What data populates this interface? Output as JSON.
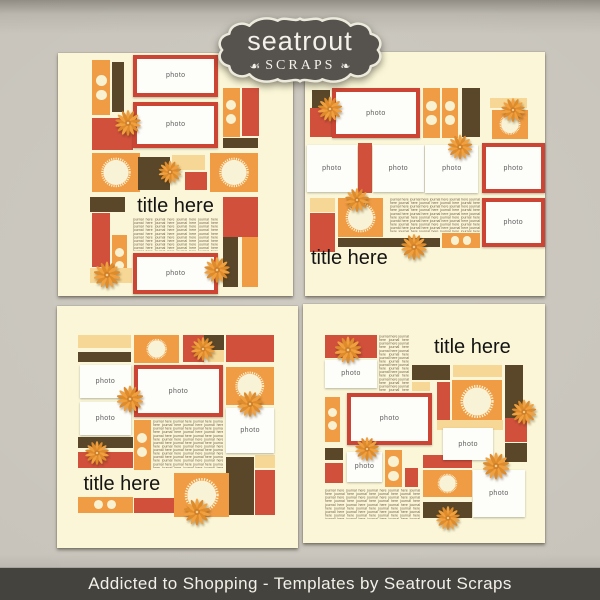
{
  "badge": {
    "brand": "seatrout",
    "subtitle": "SCRAPS",
    "flourish_left": "☙",
    "flourish_right": "❧"
  },
  "footer": {
    "caption": "Addicted to Shopping - Templates by Seatrout Scraps"
  },
  "labels": {
    "photo": "photo",
    "title": "title here",
    "journal_phrase": "journal here",
    "journal_repeat": 110
  },
  "palette": {
    "background": "#c8c4bb",
    "page": "#faf6d7",
    "orange": "#f09c44",
    "red": "#d0503c",
    "brown": "#5a4729",
    "tan": "#f6d795",
    "frame": "#cc4534",
    "photo_bg": "#fdfdfa",
    "photo_label": "#5f5f5f",
    "journal_text": "#75604b",
    "title_text": "#141414",
    "dot": "#f8f2d2",
    "scallop": "#f8f3d6",
    "flower_a": "#f1a03f",
    "flower_b": "#de8b2c",
    "flower_center": "#cf7f2a",
    "flower_dot": "#f2cd8d",
    "badge_bg": "#56534e",
    "badge_border": "#ece9dd",
    "badge_text": "#f3f1ea",
    "footer_bg": "#45433e",
    "footer_text": "#f2f0e8"
  },
  "templates": [
    {
      "name": "top-left",
      "blocks": [
        {
          "t": "dots",
          "dir": "v",
          "x": 14.5,
          "y": 3,
          "w": 7.7,
          "h": 22.5
        },
        {
          "t": "rect",
          "c": "brown",
          "x": 22.8,
          "y": 3.7,
          "w": 5.2,
          "h": 20.5
        },
        {
          "t": "photo",
          "f": true,
          "x": 32,
          "y": 0.8,
          "w": 36.2,
          "h": 17.2
        },
        {
          "t": "dots",
          "dir": "v",
          "x": 70.2,
          "y": 14.4,
          "w": 7.2,
          "h": 20
        },
        {
          "t": "rect",
          "c": "red",
          "x": 78.3,
          "y": 14.4,
          "w": 7.2,
          "h": 19.8
        },
        {
          "t": "photo",
          "f": true,
          "x": 32,
          "y": 20,
          "w": 36.2,
          "h": 19.2
        },
        {
          "t": "rect",
          "c": "red",
          "x": 14.5,
          "y": 26.7,
          "w": 17.4,
          "h": 13.2
        },
        {
          "t": "rect",
          "c": "brown",
          "x": 70.2,
          "y": 35,
          "w": 14.9,
          "h": 4.2
        },
        {
          "t": "scallop",
          "x": 14.5,
          "y": 41.2,
          "w": 20.4,
          "h": 16
        },
        {
          "t": "rect",
          "c": "brown",
          "x": 34,
          "y": 42.8,
          "w": 13.6,
          "h": 13.6
        },
        {
          "t": "rect",
          "c": "tan",
          "x": 48.5,
          "y": 42,
          "w": 14,
          "h": 6.2
        },
        {
          "t": "rect",
          "c": "red",
          "x": 54,
          "y": 49,
          "w": 9.4,
          "h": 7.5
        },
        {
          "t": "scallop",
          "x": 64.7,
          "y": 41.2,
          "w": 20.4,
          "h": 16
        },
        {
          "t": "rect",
          "c": "brown",
          "x": 13.6,
          "y": 59.3,
          "w": 14.9,
          "h": 6.2
        },
        {
          "t": "rect",
          "c": "red",
          "x": 70.2,
          "y": 59.3,
          "w": 14.9,
          "h": 16.5
        },
        {
          "t": "title",
          "align": "center",
          "x": 31,
          "y": 58.5,
          "w": 38,
          "h": 9
        },
        {
          "t": "journal",
          "x": 32,
          "y": 68,
          "w": 36.2,
          "h": 13.3
        },
        {
          "t": "rect",
          "c": "red",
          "x": 14.5,
          "y": 66,
          "w": 7.7,
          "h": 22
        },
        {
          "t": "dots",
          "dir": "v",
          "x": 23,
          "y": 75,
          "w": 6.4,
          "h": 19.8
        },
        {
          "t": "rect",
          "c": "brown",
          "x": 70.2,
          "y": 75.7,
          "w": 6.4,
          "h": 20.6
        },
        {
          "t": "rect",
          "c": "orange",
          "x": 78.3,
          "y": 75.7,
          "w": 7,
          "h": 20.6
        },
        {
          "t": "photo",
          "f": true,
          "x": 32,
          "y": 82.3,
          "w": 36.2,
          "h": 16.9
        },
        {
          "t": "rect",
          "c": "tan",
          "x": 13.6,
          "y": 88.5,
          "w": 18,
          "h": 6.2
        },
        {
          "t": "flower",
          "x": 29.8,
          "y": 28.8,
          "s": 27
        },
        {
          "t": "flower",
          "x": 47.7,
          "y": 49,
          "s": 24
        },
        {
          "t": "flower",
          "x": 20.9,
          "y": 91.4,
          "s": 28
        },
        {
          "t": "flower",
          "x": 67.7,
          "y": 89.3,
          "s": 27
        }
      ]
    },
    {
      "name": "top-right",
      "blocks": [
        {
          "t": "rect",
          "c": "brown",
          "x": 2.9,
          "y": 15.6,
          "w": 7.5,
          "h": 7.4
        },
        {
          "t": "rect",
          "c": "red",
          "x": 2.1,
          "y": 23,
          "w": 10.4,
          "h": 11.9
        },
        {
          "t": "photo",
          "f": true,
          "x": 11.2,
          "y": 14.8,
          "w": 36.7,
          "h": 20.5
        },
        {
          "t": "dots",
          "dir": "v",
          "x": 49.2,
          "y": 14.8,
          "w": 7.1,
          "h": 20.5
        },
        {
          "t": "dots",
          "dir": "v",
          "x": 57.1,
          "y": 14.8,
          "w": 6.7,
          "h": 20.5
        },
        {
          "t": "rect",
          "c": "brown",
          "x": 65.4,
          "y": 14.8,
          "w": 7.5,
          "h": 20
        },
        {
          "t": "rect",
          "c": "tan",
          "x": 77.1,
          "y": 18.9,
          "w": 15.4,
          "h": 4.2
        },
        {
          "t": "scallop",
          "x": 77.9,
          "y": 23.8,
          "w": 15,
          "h": 11.7
        },
        {
          "t": "photo",
          "x": 0.8,
          "y": 38.1,
          "w": 20.8,
          "h": 19.3
        },
        {
          "t": "rect",
          "c": "red",
          "x": 21.9,
          "y": 37.3,
          "w": 6.2,
          "h": 20.5
        },
        {
          "t": "photo",
          "x": 28.4,
          "y": 38.1,
          "w": 21,
          "h": 19.3
        },
        {
          "t": "photo",
          "x": 50.2,
          "y": 38.1,
          "w": 22,
          "h": 19.7
        },
        {
          "t": "photo",
          "f": true,
          "x": 73.8,
          "y": 37.3,
          "w": 26,
          "h": 20.5
        },
        {
          "t": "rect",
          "c": "tan",
          "x": 2.1,
          "y": 59.8,
          "w": 10.4,
          "h": 5.7
        },
        {
          "t": "rect",
          "c": "red",
          "x": 2.1,
          "y": 66,
          "w": 10.4,
          "h": 16
        },
        {
          "t": "scallop",
          "x": 13.8,
          "y": 59.8,
          "w": 18.8,
          "h": 16
        },
        {
          "t": "journal",
          "x": 35.4,
          "y": 59.8,
          "w": 37.5,
          "h": 14
        },
        {
          "t": "rect",
          "c": "brown",
          "x": 13.8,
          "y": 76.3,
          "w": 42.5,
          "h": 3.7
        },
        {
          "t": "dots",
          "dir": "h",
          "x": 57.1,
          "y": 74.2,
          "w": 15.8,
          "h": 6.2
        },
        {
          "t": "photo",
          "f": true,
          "x": 73.8,
          "y": 59.8,
          "w": 26,
          "h": 20.2
        },
        {
          "t": "title",
          "align": "left",
          "x": 2.5,
          "y": 79.5,
          "w": 34,
          "h": 10
        },
        {
          "t": "flower",
          "x": 10.4,
          "y": 23.4,
          "s": 26
        },
        {
          "t": "flower",
          "x": 86.7,
          "y": 23.6,
          "s": 25
        },
        {
          "t": "flower",
          "x": 64.6,
          "y": 39,
          "s": 26
        },
        {
          "t": "flower",
          "x": 21.7,
          "y": 60.7,
          "s": 25
        },
        {
          "t": "flower",
          "x": 45.4,
          "y": 80,
          "s": 27
        }
      ]
    },
    {
      "name": "bottom-left",
      "blocks": [
        {
          "t": "rect",
          "c": "tan",
          "x": 8.8,
          "y": 12,
          "w": 21.8,
          "h": 5.4
        },
        {
          "t": "rect",
          "c": "brown",
          "x": 8.8,
          "y": 19,
          "w": 21.8,
          "h": 4.2
        },
        {
          "t": "scallop",
          "x": 31.8,
          "y": 12,
          "w": 18.8,
          "h": 11.6
        },
        {
          "t": "rect",
          "c": "red",
          "x": 52.3,
          "y": 12,
          "w": 8.8,
          "h": 11.2
        },
        {
          "t": "rect",
          "c": "brown",
          "x": 61.1,
          "y": 12,
          "w": 8,
          "h": 6.2
        },
        {
          "t": "rect",
          "c": "tan",
          "x": 62.8,
          "y": 18.2,
          "w": 6.3,
          "h": 5
        },
        {
          "t": "rect",
          "c": "red",
          "x": 70.3,
          "y": 12,
          "w": 19.7,
          "h": 11.2
        },
        {
          "t": "photo",
          "x": 9.6,
          "y": 24.4,
          "w": 21,
          "h": 13.6
        },
        {
          "t": "photo",
          "f": true,
          "x": 31.8,
          "y": 24.4,
          "w": 37.2,
          "h": 21.5
        },
        {
          "t": "scallop",
          "x": 70.3,
          "y": 25.2,
          "w": 19.7,
          "h": 15.7
        },
        {
          "t": "photo",
          "x": 9.6,
          "y": 39.7,
          "w": 21,
          "h": 13.6
        },
        {
          "t": "photo",
          "x": 70.3,
          "y": 42.1,
          "w": 19.7,
          "h": 18.6
        },
        {
          "t": "rect",
          "c": "brown",
          "x": 8.8,
          "y": 54.1,
          "w": 22.6,
          "h": 4.5
        },
        {
          "t": "rect",
          "c": "red",
          "x": 8.8,
          "y": 60.3,
          "w": 22.6,
          "h": 6.6
        },
        {
          "t": "dots",
          "dir": "v",
          "x": 31.8,
          "y": 47.1,
          "w": 7.1,
          "h": 20.7
        },
        {
          "t": "journal",
          "x": 39.7,
          "y": 47.1,
          "w": 29.3,
          "h": 19.8
        },
        {
          "t": "title",
          "align": "left",
          "x": 11,
          "y": 69,
          "w": 36,
          "h": 9.5
        },
        {
          "t": "rect",
          "c": "brown",
          "x": 70.3,
          "y": 62.4,
          "w": 11.3,
          "h": 24
        },
        {
          "t": "rect",
          "c": "tan",
          "x": 82.3,
          "y": 61.6,
          "w": 8,
          "h": 5.4
        },
        {
          "t": "rect",
          "c": "red",
          "x": 82.3,
          "y": 67.8,
          "w": 8,
          "h": 18.6
        },
        {
          "t": "scallop",
          "x": 48.5,
          "y": 69,
          "w": 23,
          "h": 18.2
        },
        {
          "t": "dots",
          "dir": "h",
          "x": 8.8,
          "y": 78.9,
          "w": 22.6,
          "h": 6.6
        },
        {
          "t": "rect",
          "c": "red",
          "x": 31.8,
          "y": 79.3,
          "w": 16.7,
          "h": 6.2
        },
        {
          "t": "flower",
          "x": 60.7,
          "y": 17.8,
          "s": 25
        },
        {
          "t": "flower",
          "x": 79.9,
          "y": 40.5,
          "s": 27
        },
        {
          "t": "flower",
          "x": 30.1,
          "y": 38.4,
          "s": 28
        },
        {
          "t": "flower",
          "x": 16.7,
          "y": 60.7,
          "s": 25
        },
        {
          "t": "flower",
          "x": 58.2,
          "y": 85.1,
          "s": 28
        }
      ]
    },
    {
      "name": "bottom-right",
      "blocks": [
        {
          "t": "rect",
          "c": "red",
          "x": 9.1,
          "y": 13,
          "w": 21.5,
          "h": 9.6
        },
        {
          "t": "photo",
          "x": 9.1,
          "y": 23.4,
          "w": 21.5,
          "h": 11.7
        },
        {
          "t": "journal",
          "x": 31.5,
          "y": 13,
          "w": 12.4,
          "h": 24
        },
        {
          "t": "title",
          "align": "center",
          "x": 53,
          "y": 13.5,
          "w": 34,
          "h": 9
        },
        {
          "t": "rect",
          "c": "brown",
          "x": 45,
          "y": 25.5,
          "w": 15.7,
          "h": 6.3
        },
        {
          "t": "rect",
          "c": "tan",
          "x": 62,
          "y": 25.5,
          "w": 20.2,
          "h": 5
        },
        {
          "t": "rect",
          "c": "brown",
          "x": 83.5,
          "y": 25.5,
          "w": 7.4,
          "h": 23
        },
        {
          "t": "rect",
          "c": "tan",
          "x": 45,
          "y": 32.8,
          "w": 7.4,
          "h": 3.4
        },
        {
          "t": "dots",
          "dir": "v",
          "x": 9.1,
          "y": 38.9,
          "w": 6.2,
          "h": 18.8
        },
        {
          "t": "photo",
          "f": true,
          "x": 18.2,
          "y": 37.2,
          "w": 35.1,
          "h": 21.8
        },
        {
          "t": "rect",
          "c": "red",
          "x": 55.4,
          "y": 32.6,
          "w": 5.4,
          "h": 15.9
        },
        {
          "t": "scallop",
          "x": 61.6,
          "y": 31.8,
          "w": 20.7,
          "h": 18
        },
        {
          "t": "rect",
          "c": "tan",
          "x": 55.4,
          "y": 48.5,
          "w": 27.3,
          "h": 4.2
        },
        {
          "t": "rect",
          "c": "red",
          "x": 83.5,
          "y": 47.7,
          "w": 9.1,
          "h": 10
        },
        {
          "t": "photo",
          "x": 57.9,
          "y": 51.9,
          "w": 20.7,
          "h": 13.4
        },
        {
          "t": "rect",
          "c": "brown",
          "x": 9.1,
          "y": 60.3,
          "w": 7.4,
          "h": 5
        },
        {
          "t": "photo",
          "x": 18.2,
          "y": 61.9,
          "w": 14.5,
          "h": 12.6
        },
        {
          "t": "dots",
          "dir": "v",
          "x": 33.9,
          "y": 61.1,
          "w": 7,
          "h": 15.5
        },
        {
          "t": "rect",
          "c": "red",
          "x": 9.1,
          "y": 66.5,
          "w": 7.4,
          "h": 8.4
        },
        {
          "t": "rect",
          "c": "red",
          "x": 42.1,
          "y": 68.6,
          "w": 5.4,
          "h": 7.9
        },
        {
          "t": "rect",
          "c": "red",
          "x": 49.6,
          "y": 63.2,
          "w": 20.2,
          "h": 5.4
        },
        {
          "t": "rect",
          "c": "brown",
          "x": 83.5,
          "y": 58.2,
          "w": 9.1,
          "h": 7.9
        },
        {
          "t": "scallop",
          "x": 49.6,
          "y": 69.5,
          "w": 20.2,
          "h": 11.3
        },
        {
          "t": "photo",
          "x": 70.2,
          "y": 69.5,
          "w": 21.5,
          "h": 19.7
        },
        {
          "t": "journal",
          "x": 9.1,
          "y": 77.5,
          "w": 39.3,
          "h": 12.6
        },
        {
          "t": "rect",
          "c": "brown",
          "x": 49.6,
          "y": 82.8,
          "w": 20.2,
          "h": 6.7
        },
        {
          "t": "flower",
          "x": 18.6,
          "y": 19.2,
          "s": 28
        },
        {
          "t": "flower",
          "x": 91.3,
          "y": 45.2,
          "s": 26
        },
        {
          "t": "flower",
          "x": 26.4,
          "y": 60.7,
          "s": 25
        },
        {
          "t": "flower",
          "x": 79.8,
          "y": 67.8,
          "s": 28
        },
        {
          "t": "flower",
          "x": 59.9,
          "y": 89.5,
          "s": 25
        }
      ]
    }
  ]
}
